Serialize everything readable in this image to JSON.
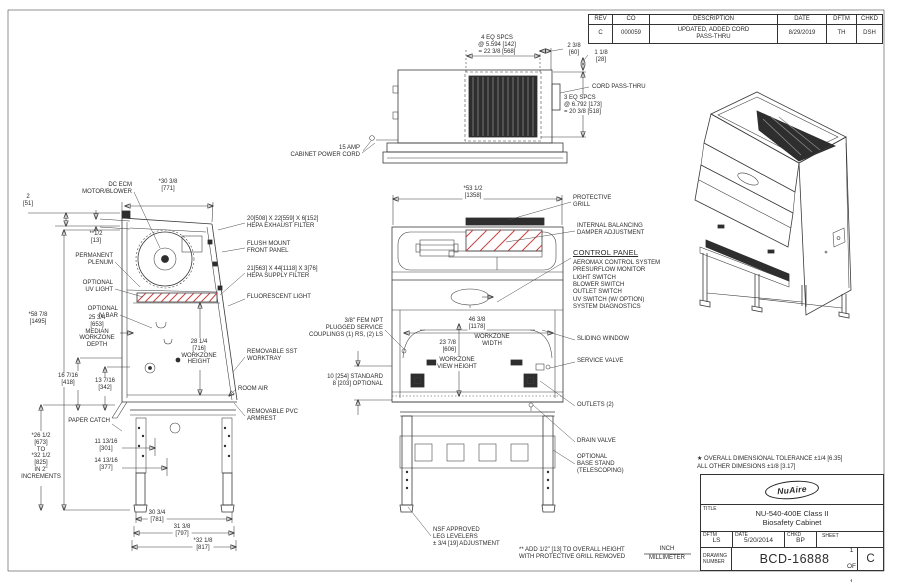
{
  "colors": {
    "line": "#3a3a3a",
    "hatch_red": "#c74440",
    "filter_dark": "#2e2e2e"
  },
  "tv": {
    "eq4": "4 EQ SPCS\n@ 5.594 [142]\n= 22 3/8 [568]",
    "d238": "2 3/8\n[60]",
    "d118": "1 1/8\n[28]",
    "cord": "CORD PASS-THRU",
    "eq3": "3 EQ SPCS\n@ 6.792 [173]\n= 20 3/8 [518]",
    "power": "15 AMP\nCABINET POWER CORD"
  },
  "sv": {
    "d2": "2\n[51]",
    "dhalf": "**1/2\n[13]",
    "motor": "DC ECM\nMOTOR/BLOWER",
    "d3038": "*30 3/8\n[771]",
    "plenum": "PERMANENT\nPLENUM",
    "uv": "OPTIONAL\nUV LIGHT",
    "ivbar": "OPTIONAL\nIV BAR",
    "d5878": "*58 7/8\n[1495]",
    "depth": "25 3/4\n[653]\nMEDIAN\nWORKZONE\nDEPTH",
    "wzh": "28 1/4\n[716]\nWORKZONE\nHEIGHT",
    "d16": "16 7/16\n[418]",
    "d13": "13 7/16\n[342]",
    "paper": "PAPER CATCH",
    "incr": "*26 1/2\n[673]\nTO\n*32 1/2\n[825]\nIN 2\"\nINCREMENTS",
    "d11": "11 13/16\n[301]",
    "d14": "14 13/16\n[377]",
    "d30": "30 3/4\n[781]",
    "d31": "31 3/8\n[797]",
    "d32": "*32 1/8\n[817]"
  },
  "mid": {
    "hexh": "20[508] X 22[559] X 6[152]\nHEPA EXHAUST FILTER",
    "flush": "FLUSH MOUNT\nFRONT PANEL",
    "hsup": "21[563] X 44[1118] X 3[76]\nHEPA SUPPLY FILTER",
    "fluor": "FLUORESCENT LIGHT",
    "tray": "REMOVABLE SST\nWORKTRAY",
    "air": "ROOM AIR",
    "arm": "REMOVABLE PVC\nARMREST",
    "npt": "3/8\" FEM NPT\nPLUGGED SERVICE\nCOUPLINGS (1) RS, (2) LS",
    "std": "10 [254] STANDARD\n8 [203] OPTIONAL"
  },
  "fv": {
    "d5312": "*53 1/2\n[1358]",
    "wdim": "46 3/8\n[1178]",
    "wlabel": "WORKZONE\nWIDTH",
    "d2378": "23 7/8\n[606]",
    "vh": "WORKZONE\nVIEW HEIGHT",
    "logo": "NuAire"
  },
  "rt": {
    "grill": "PROTECTIVE\nGRILL",
    "damper": "INTERNAL BALANCING\nDAMPER ADJUSTMENT",
    "cpt": "CONTROL PANEL",
    "cpi": "AEROMAX CONTROL SYSTEM\nPRESURFLOW MONITOR\nLIGHT SWITCH\nBLOWER SWITCH\nOUTLET SWITCH\nUV SWITCH (W/ OPTION)\nSYSTEM DIAGNOSTICS",
    "slide": "SLIDING WINDOW",
    "valve": "SERVICE VALVE",
    "outlets": "OUTLETS (2)",
    "drain": "DRAIN VALVE",
    "base": "OPTIONAL\nBASE STAND\n(TELESCOPING)"
  },
  "bt": {
    "nsf": "NSF APPROVED\nLEG LEVELERS\n± 3/4 [19] ADJUSTMENT",
    "note": "** ADD 1/2\" [13] TO OVERALL HEIGHT\nWITH PROTECTIVE GRILL REMOVED",
    "inch": "INCH",
    "mm": "MILLIMETER"
  },
  "rev": {
    "h": [
      "REV",
      "CO",
      "DESCRIPTION",
      "DATE",
      "DFTM",
      "CHKD"
    ],
    "rev": "C",
    "co": "000059",
    "desc": "UPDATED, ADDED CORD\nPASS-THRU",
    "date": "8/29/2019",
    "dftm": "TH",
    "chkd": "DSH"
  },
  "tb": {
    "tol": "★ OVERALL DIMENSIONAL TOLERANCE ±1/4 [6.35]\nALL OTHER DIMESIONS ±1/8 [3.17]",
    "logo": "NuAire",
    "title_label": "TITLE",
    "title": "NU-540-400E Class II\nBiosafety Cabinet",
    "dftm_label": "DFTM",
    "dftm": "LS",
    "date_label": "DATE",
    "date": "5/20/2014",
    "chkd_label": "CHKD",
    "chkd": "BP",
    "sheet_label": "SHEET",
    "sheet": "1",
    "of": "OF",
    "total": "1",
    "dn_label": "DRAWING\nNUMBER",
    "dn": "BCD-16888",
    "rev": "C"
  }
}
